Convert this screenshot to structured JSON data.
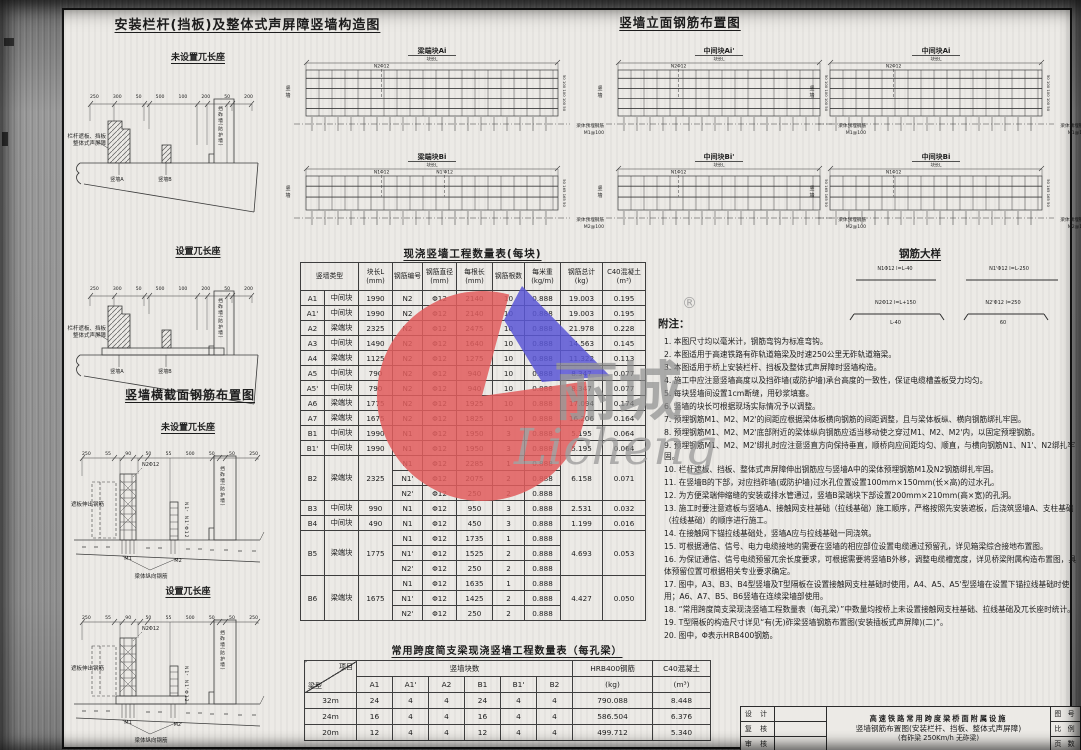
{
  "construction": {
    "title": "安装栏杆(挡板)及整体式声屏障竖墙构造图",
    "sub1": "未设置兀长座",
    "sub2": "设置兀长座",
    "left_label1": "栏杆遮板、挡板",
    "left_label2": "整体式声屏障",
    "wall_a": "竖墙A",
    "wall_b": "竖墙B",
    "ballast_wall": "挡砟墙(防护墙)",
    "dims": [
      "250",
      "300",
      "50",
      "500",
      "100",
      "200",
      "50",
      "200"
    ]
  },
  "cross_section": {
    "title": "竖墙横截面钢筋布置图",
    "sub1": "未设置兀长座",
    "sub2": "设置兀长座",
    "zheban_label": "遮板伸出钢筋",
    "n2_label": "N2Φ12",
    "n1_label": "N1、N1'Φ12",
    "m1_label": "M1",
    "m2_label": "M2",
    "m2p_label": "M2'",
    "ballast_wall": "挡砟墙(防护墙)",
    "beam_rebar_label": "梁体纵向钢筋",
    "dims": [
      "250",
      "55",
      "90",
      "50",
      "55",
      "500",
      "50",
      "50",
      "250"
    ]
  },
  "elevation": {
    "title": "竖墙立面钢筋布置图",
    "wall_side_label": "竖墙",
    "panels": [
      {
        "name": "梁端块Ai",
        "dim": "块长L",
        "n1": "N2Φ12",
        "n2": "",
        "side_dims": "50 100 100 100 50",
        "embed1": "梁体预埋钢筋",
        "embed2": "M1@100"
      },
      {
        "name": "中间块Ai'",
        "dim": "块长L",
        "n1": "N2Φ12",
        "n2": "",
        "side_dims": "50 100 100 100 50",
        "embed1": "梁体预埋钢筋",
        "embed2": "M1@100"
      },
      {
        "name": "中间块Ai",
        "dim": "块长L",
        "n1": "N2Φ12",
        "n2": "",
        "side_dims": "50 100 100 100 50",
        "embed1": "梁体预埋钢筋",
        "embed2": "M1@125"
      },
      {
        "name": "梁端块Bi",
        "dim": "块长L",
        "n1": "N1Φ12",
        "n2": "N1'Φ12",
        "side_dims": "50 165 165 50",
        "embed1": "梁体预埋钢筋",
        "embed2": "M2@100"
      },
      {
        "name": "中间块Bi'",
        "dim": "块长L",
        "n1": "N1Φ12",
        "n2": "",
        "side_dims": "50 165 165 50",
        "embed1": "梁体预埋钢筋",
        "embed2": "M2@100"
      },
      {
        "name": "中间块Bi",
        "dim": "块长L",
        "n1": "N1Φ12",
        "n2": "",
        "side_dims": "50 165 165 50",
        "embed1": "梁体预埋钢筋",
        "embed2": "M2@125"
      }
    ]
  },
  "rebar_detail": {
    "title": "钢筋大样",
    "items": [
      {
        "label": "N1Φ12 l=L-40",
        "sub": ""
      },
      {
        "label": "N1'Φ12 l=L-250",
        "sub": ""
      },
      {
        "label": "N2Φ12 l=L+150",
        "sub": "L-40"
      },
      {
        "label": "N2'Φ12 l=250",
        "sub": "60"
      }
    ]
  },
  "block_table": {
    "title": "现浇竖墙工程数量表(每块)",
    "headers": [
      {
        "t": "竖墙类型",
        "u": ""
      },
      {
        "t": "块长L",
        "u": "(mm)"
      },
      {
        "t": "钢筋编号",
        "u": ""
      },
      {
        "t": "钢筋直径",
        "u": "(mm)"
      },
      {
        "t": "每根长",
        "u": "(mm)"
      },
      {
        "t": "钢筋根数",
        "u": ""
      },
      {
        "t": "每米重",
        "u": "(kg/m)"
      },
      {
        "t": "钢筋总计",
        "u": "(kg)"
      },
      {
        "t": "C40混凝土",
        "u": "(m³)"
      }
    ],
    "blocks": [
      {
        "code": "A1",
        "type": "中间块",
        "len": "1990",
        "total": "19.003",
        "conc": "0.195",
        "bars": [
          {
            "no": "N2",
            "dia": "Φ12",
            "blen": "2140",
            "cnt": "10",
            "wt": "0.888"
          }
        ]
      },
      {
        "code": "A1'",
        "type": "中间块",
        "len": "1990",
        "total": "19.003",
        "conc": "0.195",
        "bars": [
          {
            "no": "N2",
            "dia": "Φ12",
            "blen": "2140",
            "cnt": "10",
            "wt": "0.888"
          }
        ]
      },
      {
        "code": "A2",
        "type": "梁端块",
        "len": "2325",
        "total": "21.978",
        "conc": "0.228",
        "bars": [
          {
            "no": "N2",
            "dia": "Φ12",
            "blen": "2475",
            "cnt": "10",
            "wt": "0.888"
          }
        ]
      },
      {
        "code": "A3",
        "type": "中间块",
        "len": "1490",
        "total": "14.563",
        "conc": "0.145",
        "bars": [
          {
            "no": "N2",
            "dia": "Φ12",
            "blen": "1640",
            "cnt": "10",
            "wt": "0.888"
          }
        ]
      },
      {
        "code": "A4",
        "type": "梁端块",
        "len": "1125",
        "total": "11.322",
        "conc": "0.113",
        "bars": [
          {
            "no": "N2",
            "dia": "Φ12",
            "blen": "1275",
            "cnt": "10",
            "wt": "0.888"
          }
        ]
      },
      {
        "code": "A5",
        "type": "中间块",
        "len": "790",
        "total": "8.347",
        "conc": "0.077",
        "bars": [
          {
            "no": "N2",
            "dia": "Φ12",
            "blen": "940",
            "cnt": "10",
            "wt": "0.888"
          }
        ]
      },
      {
        "code": "A5'",
        "type": "中间块",
        "len": "790",
        "total": "8.347",
        "conc": "0.077",
        "bars": [
          {
            "no": "N2",
            "dia": "Φ12",
            "blen": "940",
            "cnt": "10",
            "wt": "0.888"
          }
        ]
      },
      {
        "code": "A6",
        "type": "梁端块",
        "len": "1775",
        "total": "17.094",
        "conc": "0.174",
        "bars": [
          {
            "no": "N2",
            "dia": "Φ12",
            "blen": "1925",
            "cnt": "10",
            "wt": "0.888"
          }
        ]
      },
      {
        "code": "A7",
        "type": "梁端块",
        "len": "1675",
        "total": "16.206",
        "conc": "0.164",
        "bars": [
          {
            "no": "N2",
            "dia": "Φ12",
            "blen": "1825",
            "cnt": "10",
            "wt": "0.888"
          }
        ]
      },
      {
        "code": "B1",
        "type": "中间块",
        "len": "1990",
        "total": "5.195",
        "conc": "0.064",
        "bars": [
          {
            "no": "N1",
            "dia": "Φ12",
            "blen": "1950",
            "cnt": "3",
            "wt": "0.888"
          }
        ]
      },
      {
        "code": "B1'",
        "type": "中间块",
        "len": "1990",
        "total": "5.195",
        "conc": "0.064",
        "bars": [
          {
            "no": "N1",
            "dia": "Φ12",
            "blen": "1950",
            "cnt": "3",
            "wt": "0.888"
          }
        ]
      },
      {
        "code": "B2",
        "type": "梁端块",
        "len": "2325",
        "total": "6.158",
        "conc": "0.071",
        "bars": [
          {
            "no": "N1",
            "dia": "Φ12",
            "blen": "2285",
            "cnt": "1",
            "wt": "0.888"
          },
          {
            "no": "N1'",
            "dia": "Φ12",
            "blen": "2075",
            "cnt": "2",
            "wt": "0.888"
          },
          {
            "no": "N2'",
            "dia": "Φ12",
            "blen": "250",
            "cnt": "2",
            "wt": "0.888"
          }
        ]
      },
      {
        "code": "B3",
        "type": "中间块",
        "len": "990",
        "total": "2.531",
        "conc": "0.032",
        "bars": [
          {
            "no": "N1",
            "dia": "Φ12",
            "blen": "950",
            "cnt": "3",
            "wt": "0.888"
          }
        ]
      },
      {
        "code": "B4",
        "type": "中间块",
        "len": "490",
        "total": "1.199",
        "conc": "0.016",
        "bars": [
          {
            "no": "N1",
            "dia": "Φ12",
            "blen": "450",
            "cnt": "3",
            "wt": "0.888"
          }
        ]
      },
      {
        "code": "B5",
        "type": "梁端块",
        "len": "1775",
        "total": "4.693",
        "conc": "0.053",
        "bars": [
          {
            "no": "N1",
            "dia": "Φ12",
            "blen": "1735",
            "cnt": "1",
            "wt": "0.888"
          },
          {
            "no": "N1'",
            "dia": "Φ12",
            "blen": "1525",
            "cnt": "2",
            "wt": "0.888"
          },
          {
            "no": "N2'",
            "dia": "Φ12",
            "blen": "250",
            "cnt": "2",
            "wt": "0.888"
          }
        ]
      },
      {
        "code": "B6",
        "type": "梁端块",
        "len": "1675",
        "total": "4.427",
        "conc": "0.050",
        "bars": [
          {
            "no": "N1",
            "dia": "Φ12",
            "blen": "1635",
            "cnt": "1",
            "wt": "0.888"
          },
          {
            "no": "N1'",
            "dia": "Φ12",
            "blen": "1425",
            "cnt": "2",
            "wt": "0.888"
          },
          {
            "no": "N2'",
            "dia": "Φ12",
            "blen": "250",
            "cnt": "2",
            "wt": "0.888"
          }
        ]
      }
    ]
  },
  "span_table": {
    "title": "常用跨度简支梁现浇竖墙工程数量表（每孔梁）",
    "corner_top": "项目",
    "corner_bottom": "梁型",
    "group": "竖墙块数",
    "cols": [
      "A1",
      "A1'",
      "A2",
      "B1",
      "B1'",
      "B2"
    ],
    "steel_t": "HRB400钢筋",
    "steel_u": "(kg)",
    "conc_t": "C40混凝土",
    "conc_u": "(m³)",
    "rows": [
      {
        "span": "32m",
        "counts": [
          "24",
          "4",
          "4",
          "24",
          "4",
          "4"
        ],
        "steel": "790.088",
        "conc": "8.448"
      },
      {
        "span": "24m",
        "counts": [
          "16",
          "4",
          "4",
          "16",
          "4",
          "4"
        ],
        "steel": "586.504",
        "conc": "6.376"
      },
      {
        "span": "20m",
        "counts": [
          "12",
          "4",
          "4",
          "12",
          "4",
          "4"
        ],
        "steel": "499.712",
        "conc": "5.340"
      }
    ]
  },
  "notes": {
    "title": "附注：",
    "items": [
      "1. 本图尺寸均以毫米计，钢筋弯钩为标准弯钩。",
      "2. 本图适用于高速铁路有砟轨道箱梁及时速250公里无砟轨道箱梁。",
      "3. 本图适用于桥上安装栏杆、挡板及整体式声屏障时竖墙构造。",
      "4. 施工中应注意竖墙高度以及挡砟墙(或防护墙)承台高度的一致性，保证电缆槽盖板受力均匀。",
      "5. 每块竖墙间设置1cm断缝，用砂浆填塞。",
      "6. 竖墙的块长可根据现场实际情况予以调整。",
      "7. 预埋钢筋M1、M2、M2'的间距应根据梁体板横向钢筋的间距调整，且与梁体板纵、横向钢筋绑扎牢固。",
      "8. 预埋钢筋M1、M2、M2'底部附近的梁体纵向钢筋应适当移动使之穿过M1、M2、M2'内，以固定预埋钢筋。",
      "9. 预埋钢筋M1、M2、M2'绑扎时应注意竖直方向保持垂直，顺桥向应间距均匀、顺直，与横向钢筋N1、N1'、N2绑扎牢固。",
      "10. 栏杆遮板、挡板、整体式声屏障伸出钢筋应与竖墙A中的梁体预埋钢筋M1及N2钢筋绑扎牢固。",
      "11. 在竖墙B的下部，对应挡砟墙(或防护墙)过水孔位置设置100mm×150mm(长×高)的过水孔。",
      "12. 为方便梁端伸缩缝的安装或排水管通过，竖墙B梁端块下部设置200mm×210mm(高×宽)的孔洞。",
      "13. 施工时要注意遮板与竖墙A、接触网支柱基础（拉线基础）施工顺序，严格按照先安装遮板，后浇筑竖墙A、支柱基础（拉线基础）的顺序进行施工。",
      "14. 在接触网下锚拉线基础处，竖墙A应与拉线基础一同浇筑。",
      "15. 可根据通信、信号、电力电缆接地的需要在竖墙的相应部位设置电缆通过预留孔，详见箱梁综合接地布置图。",
      "16. 为保证通信、信号电缆预留兀余长度要求，可根据需要将竖墙B外移，调整电缆槽宽度，详见桥梁附属构造布置图，具体预留位置可根据相关专业要求确定。",
      "17. 图中，A3、B3、B4型竖墙及T型隔板在设置接触网支柱基础时使用，A4、A5、A5'型竖墙在设置下锚拉线基础时使用；A6、A7、B5、B6竖墙在连续梁墙部使用。",
      "18. “常用跨度简支梁现浇竖墙工程数量表（每孔梁）”中数量均按桥上未设置接触网支柱基础、拉线基础及兀长座时统计。",
      "19. T型隔板的构造尺寸详见“有(无)砟梁竖墙钢筋布置图(安装插板式声屏障)(二)”。",
      "20. 图中，Φ表示HRB400钢筋。"
    ]
  },
  "title_block": {
    "left_labels": [
      "设 计",
      "复 核",
      "审 核"
    ],
    "line1": "高速铁路常用跨度梁桥面附属设施",
    "line2": "竖墙钢筋布置图(安装栏杆、挡板、整体式声屏障)",
    "line3": "(有砟梁 250Km/h 无砟梁)",
    "right_labels": [
      "图 号",
      "比 例",
      "页 数"
    ]
  },
  "watermark": {
    "cn": "丽城",
    "en": "Licheng",
    "reg": "®",
    "red": "#e25d5d",
    "blue": "#5b57d6"
  }
}
